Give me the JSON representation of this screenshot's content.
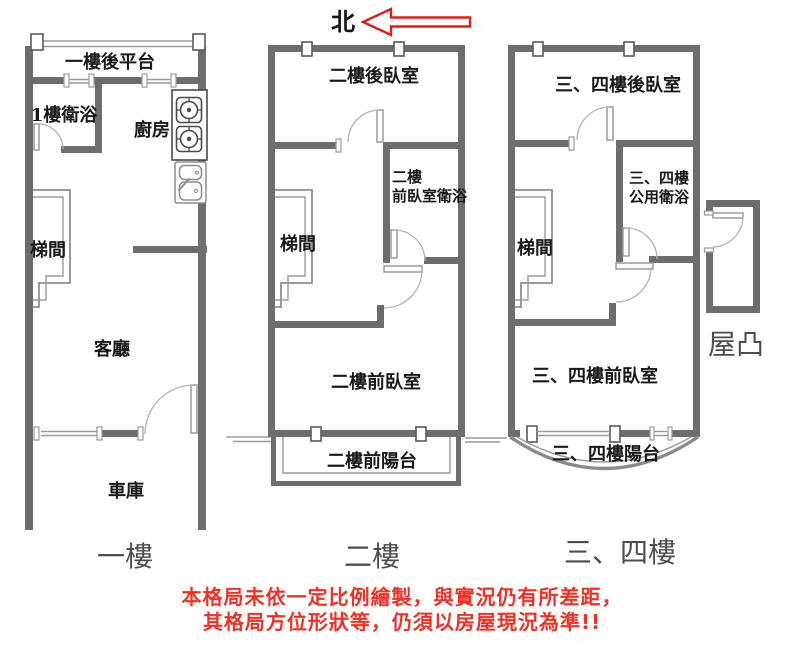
{
  "north": {
    "label": "北"
  },
  "floor1": {
    "floor_label": "一樓",
    "rear_platform": "一樓後平台",
    "bathroom": "1樓衛浴",
    "kitchen": "廚房",
    "stairwell": "梯間",
    "living_room": "客廳",
    "garage": "車庫"
  },
  "floor2": {
    "floor_label": "二樓",
    "rear_bedroom": "二樓後臥室",
    "front_bath_line1": "二樓",
    "front_bath_line2": "前臥室衛浴",
    "stairwell": "梯間",
    "front_bedroom": "二樓前臥室",
    "front_balcony": "二樓前陽台"
  },
  "floor34": {
    "floor_label": "三、四樓",
    "rear_bedroom": "三、四樓後臥室",
    "shared_bath_line1": "三、四樓",
    "shared_bath_line2": "公用衛浴",
    "stairwell": "梯間",
    "front_bedroom": "三、四樓前臥室",
    "balcony": "三、四樓陽台"
  },
  "roof": {
    "label": "屋凸"
  },
  "disclaimer": {
    "line1": "本格局未依一定比例繪製，與實況仍有所差距，",
    "line2": "其格局方位形狀等，仍須以房屋現況為準!!"
  },
  "colors": {
    "wall": "#6d6d6d",
    "thin_line": "#9b9b9b",
    "north_arrow_red": "#dd2016",
    "disclaimer_red": "#ee3124"
  }
}
